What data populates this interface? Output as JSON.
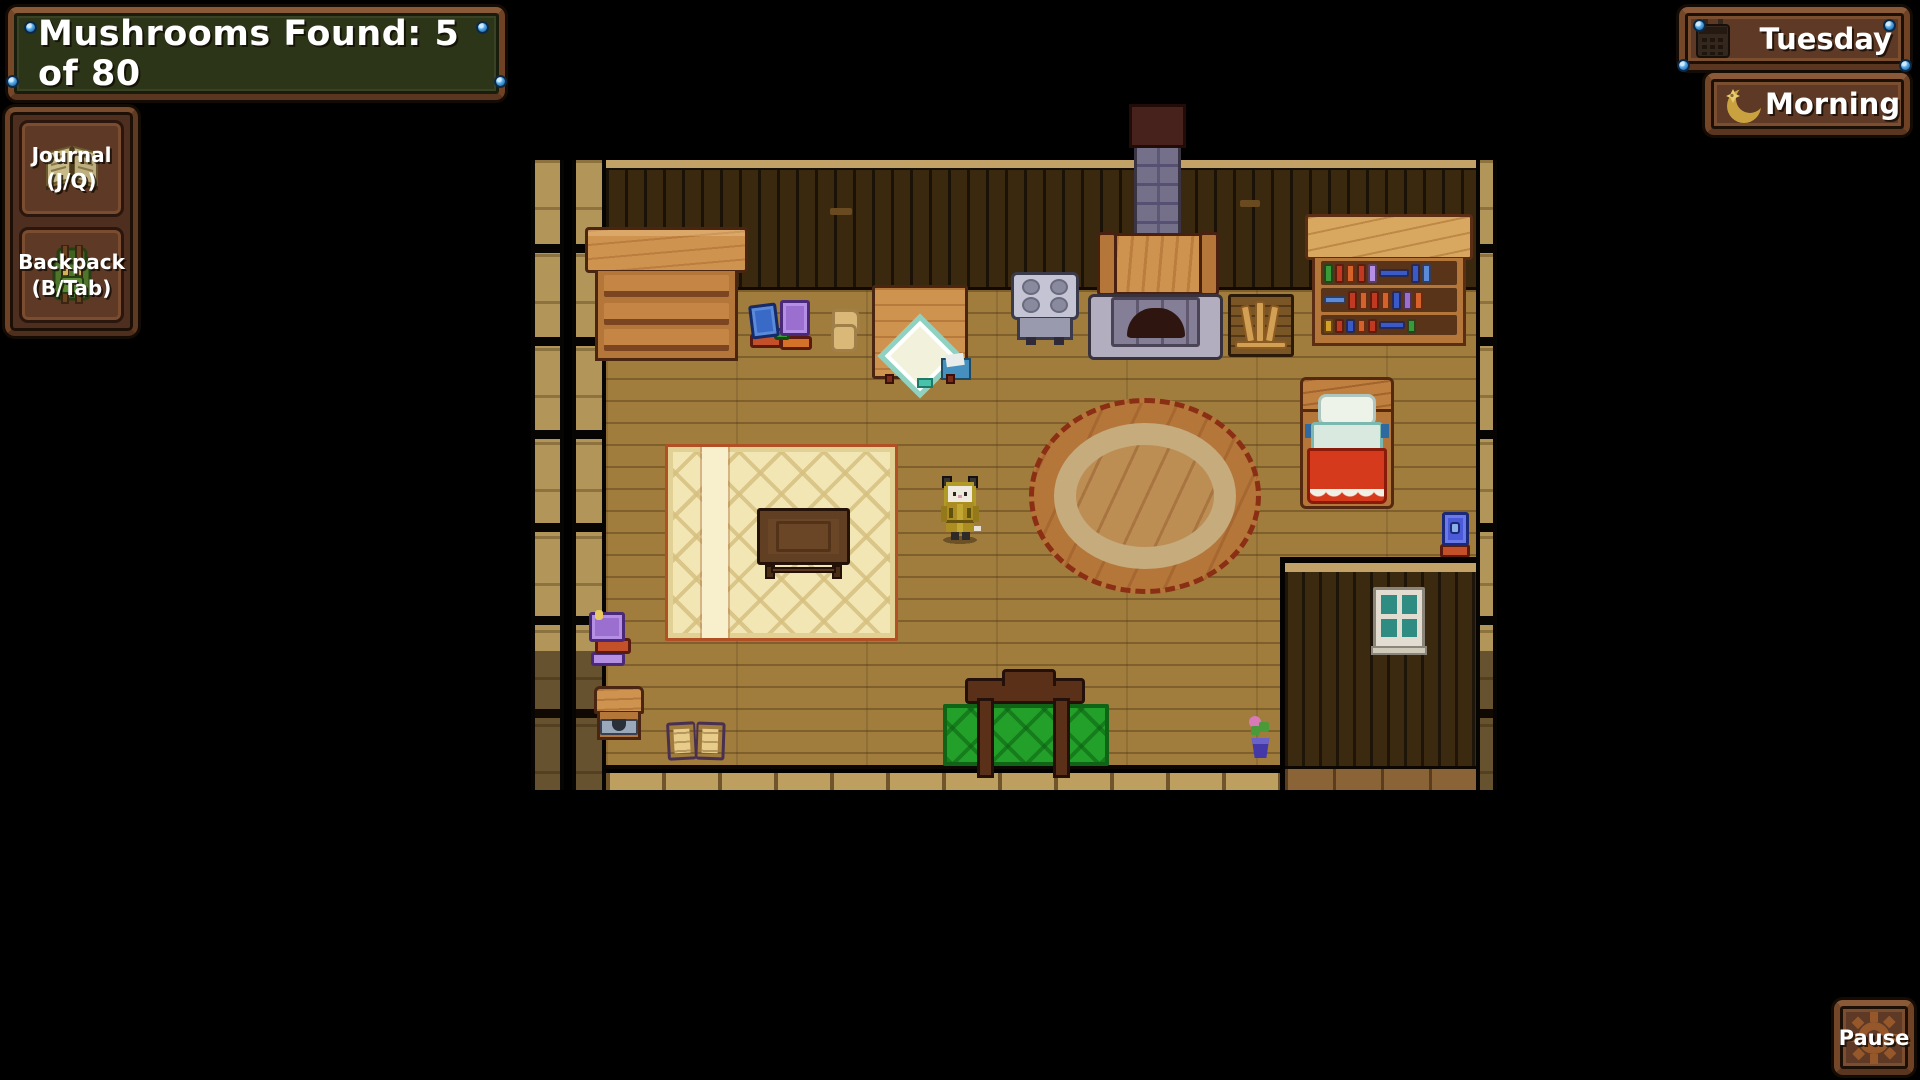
{
  "hud": {
    "mushroom_counter": {
      "label": "Mushrooms Found: 5 of 80"
    },
    "journal_button": {
      "label_line1": "Journal",
      "label_line2": "(J/Q)",
      "icon": "open-book-icon"
    },
    "backpack_button": {
      "label_line1": "Backpack",
      "label_line2": "(B/Tab)",
      "icon": "backpack-icon"
    },
    "day_panel": {
      "label": "Tuesday",
      "icon": "calendar-icon"
    },
    "time_panel": {
      "label": "Morning",
      "icon": "crescent-moon-icon"
    },
    "pause_button": {
      "label": "Pause",
      "icon": "gear-icon"
    }
  },
  "colors": {
    "hud_wood_border": "#6f4226",
    "hud_panel_brown": "#5d3926",
    "counter_green": "#2d3519",
    "pin_blue": "#5ab0ec",
    "text_white": "#ffffff",
    "floor_wood": "#a07c3d",
    "wall_dark_wood": "#3a280f",
    "rug_cream": "#f2e6b4",
    "round_rug_orange": "#b5763a",
    "blanket_red": "#d63a1c",
    "mat_green": "#23a02a"
  },
  "scene": {
    "setting": "cabin-interior-top-down",
    "objects": [
      "dresser",
      "book-pile",
      "paper-scrap",
      "side-table-with-cloth-and-envelope",
      "stove",
      "fireplace-with-chimney",
      "firewood-rack",
      "bookshelf",
      "large-patterned-rug",
      "writing-desk",
      "player-character",
      "round-braided-rug",
      "bed",
      "book-stack",
      "stacked-purple-books",
      "storage-chest",
      "open-book",
      "green-mat-with-easel",
      "potted-flower",
      "annex-room-with-window"
    ]
  }
}
